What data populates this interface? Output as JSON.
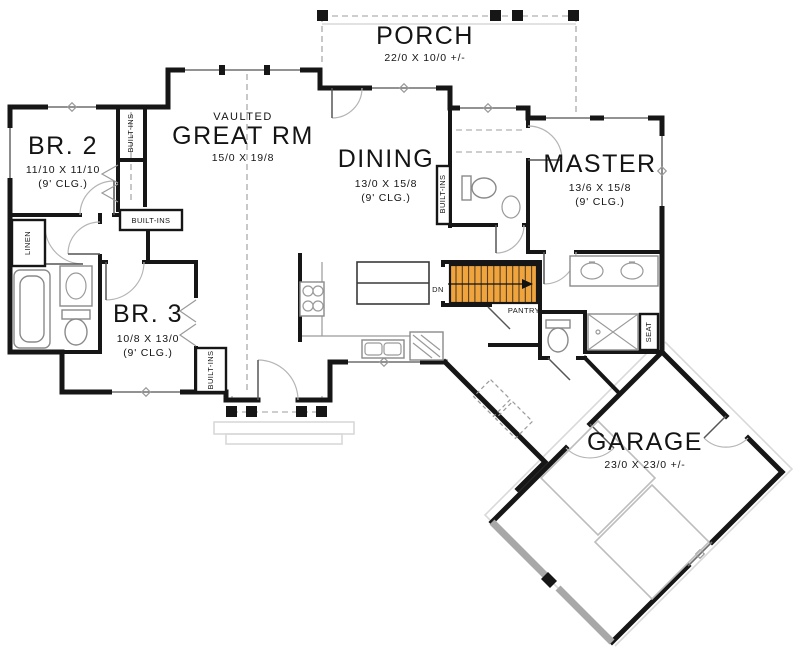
{
  "plan": {
    "title": "first-floor-plan",
    "rooms": {
      "porch": {
        "name": "PORCH",
        "dims": "22/0 X 10/0 +/-"
      },
      "great_rm": {
        "tag": "VAULTED",
        "name": "GREAT RM",
        "dims": "15/0 X 19/8"
      },
      "br2": {
        "name": "BR. 2",
        "dims": "11/10 X 11/10",
        "clg": "(9' CLG.)"
      },
      "dining": {
        "name": "DINING",
        "dims": "13/0 X 15/8",
        "clg": "(9' CLG.)"
      },
      "master": {
        "name": "MASTER",
        "dims": "13/6 X 15/8",
        "clg": "(9' CLG.)"
      },
      "br3": {
        "name": "BR. 3",
        "dims": "10/8 X 13/0",
        "clg": "(9' CLG.)"
      },
      "garage": {
        "name": "GARAGE",
        "dims": "23/0 X 23/0 +/-"
      }
    },
    "labels": {
      "built_ins": "BUILT-INS",
      "linen": "LINEN",
      "pantry": "PANTRY",
      "seat": "SEAT",
      "down": "DN"
    },
    "colors": {
      "stair_highlight": "#F0A43E",
      "walls": "#161616"
    }
  }
}
